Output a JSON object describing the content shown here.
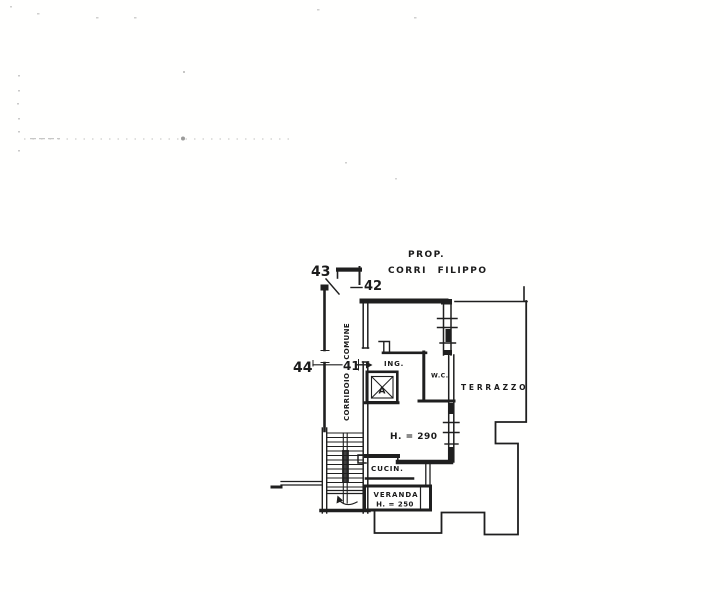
{
  "plan": {
    "property": {
      "line1": "PROP.",
      "line2": "CORRI FILIPPO"
    },
    "markers": {
      "m43": "43",
      "m42": "42",
      "m44": "44",
      "m41": "41"
    },
    "rooms": {
      "corridor": "CORRIDOIO COMUNE",
      "entrance": "ING.",
      "wc": "W.C.",
      "elevator": "A",
      "terrace": "TERRAZZO",
      "main_height": "H. = 290",
      "kitchen": "CUCIN.",
      "veranda_line1": "VERANDA",
      "veranda_line2": "H. = 250"
    },
    "colors": {
      "ink": "#1f1f1f",
      "paper": "#fffffe"
    }
  }
}
